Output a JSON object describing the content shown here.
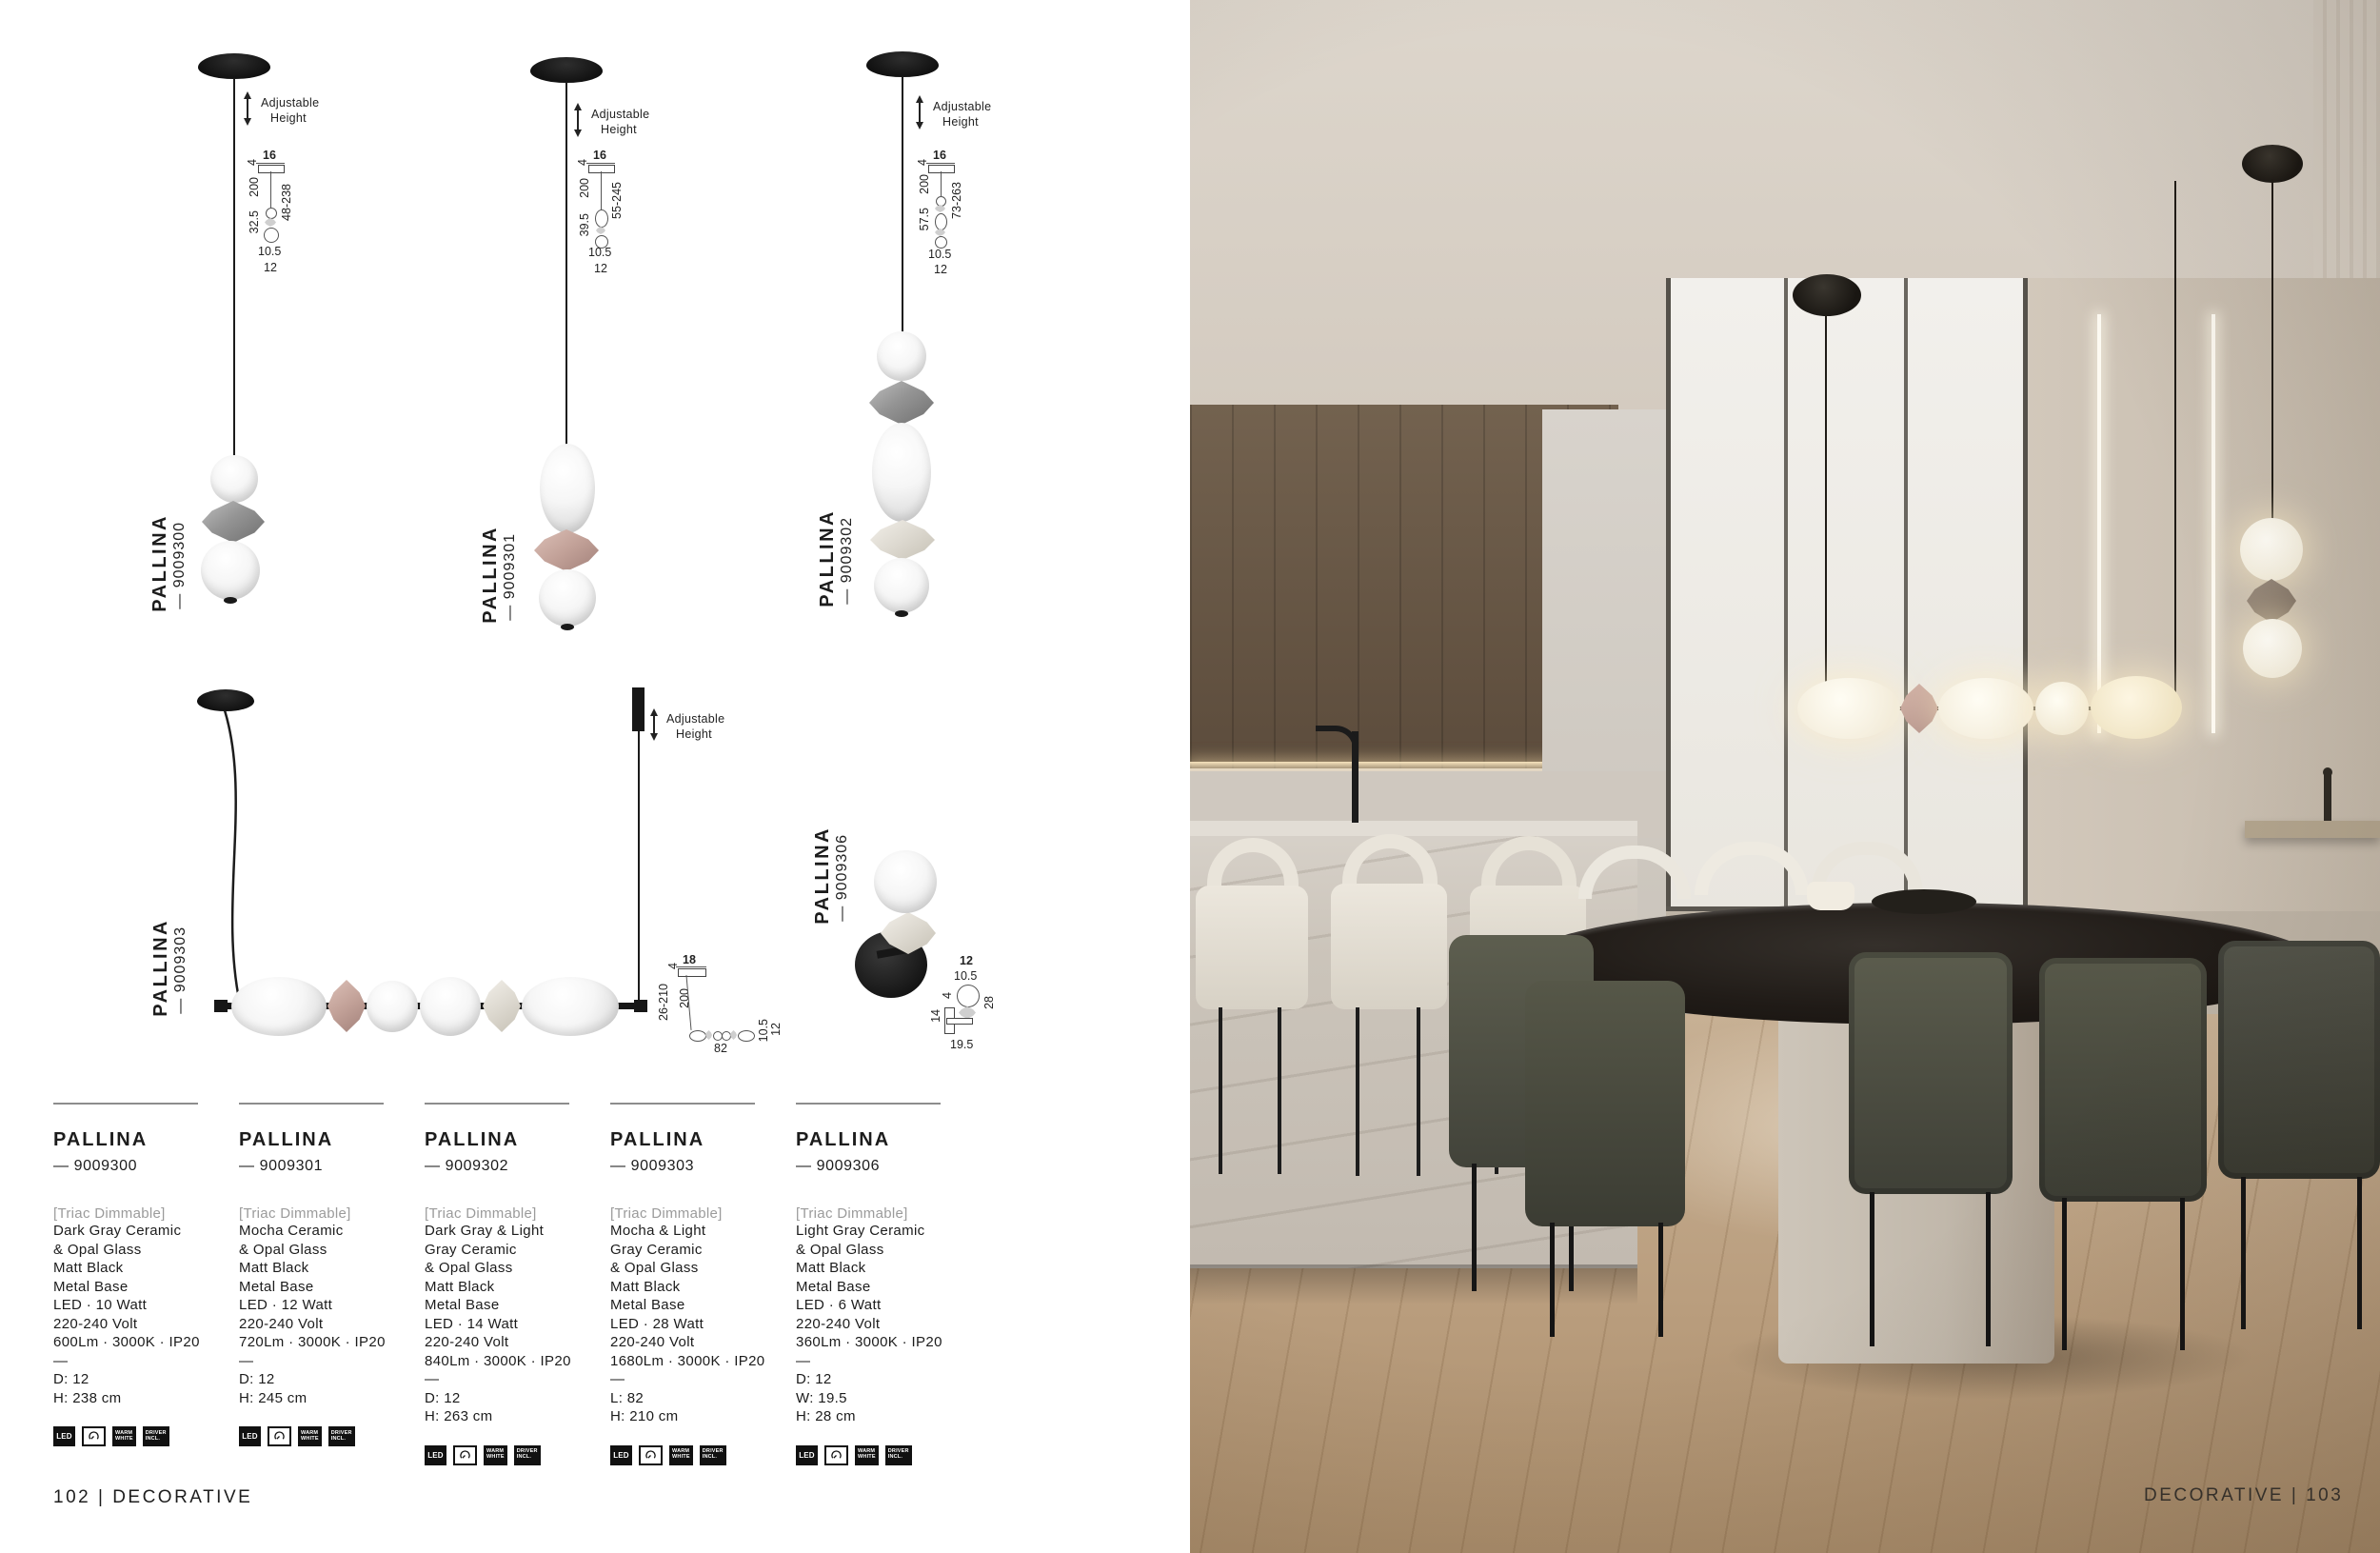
{
  "palette": {
    "page_bg": "#ffffff",
    "text": "#1c1c1c",
    "muted_text": "#9b9b9b",
    "mocha_bead": "#c2a198",
    "dark_gray_bead": "#8e8e8e",
    "light_gray_bead": "#ddd9d0",
    "matt_black": "#171717"
  },
  "catalog": {
    "footer_left": "102 | DECORATIVE",
    "footer_right": "DECORATIVE | 103",
    "adjustable": {
      "l1": "Adjustable",
      "l2": "Height"
    },
    "icons": {
      "led": "LED",
      "warm_l1": "WARM",
      "warm_l2": "WHITE",
      "driver_l1": "DRIVER",
      "driver_l2": "INCL."
    },
    "products": [
      {
        "name": "PALLINA",
        "sku": "— 9009300",
        "dims": {
          "top_w": "16",
          "canopy_h": "4",
          "cable": "200",
          "fixture_h": "32.5",
          "total": "48-238",
          "w_inner": "10.5",
          "w_outer": "12"
        }
      },
      {
        "name": "PALLINA",
        "sku": "— 9009301",
        "dims": {
          "top_w": "16",
          "canopy_h": "4",
          "cable": "200",
          "fixture_h": "39.5",
          "total": "55-245",
          "w_inner": "10.5",
          "w_outer": "12"
        }
      },
      {
        "name": "PALLINA",
        "sku": "— 9009302",
        "dims": {
          "top_w": "16",
          "canopy_h": "4",
          "cable": "200",
          "fixture_h": "57.5",
          "total": "73-263",
          "w_inner": "10.5",
          "w_outer": "12"
        }
      },
      {
        "name": "PALLINA",
        "sku": "— 9009303",
        "dims": {
          "top_w": "18",
          "canopy_h": "4",
          "drop": "26-210",
          "cable": "200",
          "length": "82",
          "h_inner": "10.5",
          "h_outer": "12"
        }
      },
      {
        "name": "PALLINA",
        "sku": "— 9009306",
        "dims": {
          "d": "12",
          "w_inner": "10.5",
          "arm": "4",
          "base": "14",
          "h": "28",
          "depth": "19.5"
        }
      }
    ],
    "specs": [
      {
        "title": "PALLINA",
        "sku": "— 9009300",
        "dimmable": "[Triac Dimmable]",
        "lines": [
          "Dark Gray Ceramic",
          "& Opal Glass",
          "Matt Black",
          "Metal Base",
          "LED · 10 Watt",
          "220-240 Volt",
          "600Lm · 3000K · IP20"
        ],
        "divider": "—",
        "sizes": [
          "D: 12",
          "H: 238 cm"
        ]
      },
      {
        "title": "PALLINA",
        "sku": "— 9009301",
        "dimmable": "[Triac Dimmable]",
        "lines": [
          "Mocha Ceramic",
          "& Opal Glass",
          "Matt Black",
          "Metal Base",
          "LED · 12 Watt",
          "220-240 Volt",
          "720Lm · 3000K · IP20"
        ],
        "divider": "—",
        "sizes": [
          "D: 12",
          "H: 245 cm"
        ]
      },
      {
        "title": "PALLINA",
        "sku": "— 9009302",
        "dimmable": "[Triac Dimmable]",
        "lines": [
          "Dark Gray & Light",
          "Gray Ceramic",
          "& Opal Glass",
          "Matt Black",
          "Metal Base",
          "LED · 14 Watt",
          "220-240 Volt",
          "840Lm · 3000K · IP20"
        ],
        "divider": "—",
        "sizes": [
          "D: 12",
          "H: 263 cm"
        ]
      },
      {
        "title": "PALLINA",
        "sku": "— 9009303",
        "dimmable": "[Triac Dimmable]",
        "lines": [
          "Mocha & Light",
          "Gray Ceramic",
          "& Opal Glass",
          "Matt Black",
          "Metal Base",
          "LED · 28 Watt",
          "220-240 Volt",
          "1680Lm · 3000K · IP20"
        ],
        "divider": "—",
        "sizes": [
          "L: 82",
          "H: 210 cm"
        ]
      },
      {
        "title": "PALLINA",
        "sku": "— 9009306",
        "dimmable": "[Triac Dimmable]",
        "lines": [
          "Light Gray Ceramic",
          "& Opal Glass",
          "Matt Black",
          "Metal Base",
          "LED ·  6 Watt",
          "220-240 Volt",
          "360Lm · 3000K · IP20"
        ],
        "divider": "—",
        "sizes": [
          "D: 12",
          "W: 19.5",
          "H: 28 cm"
        ]
      }
    ]
  }
}
